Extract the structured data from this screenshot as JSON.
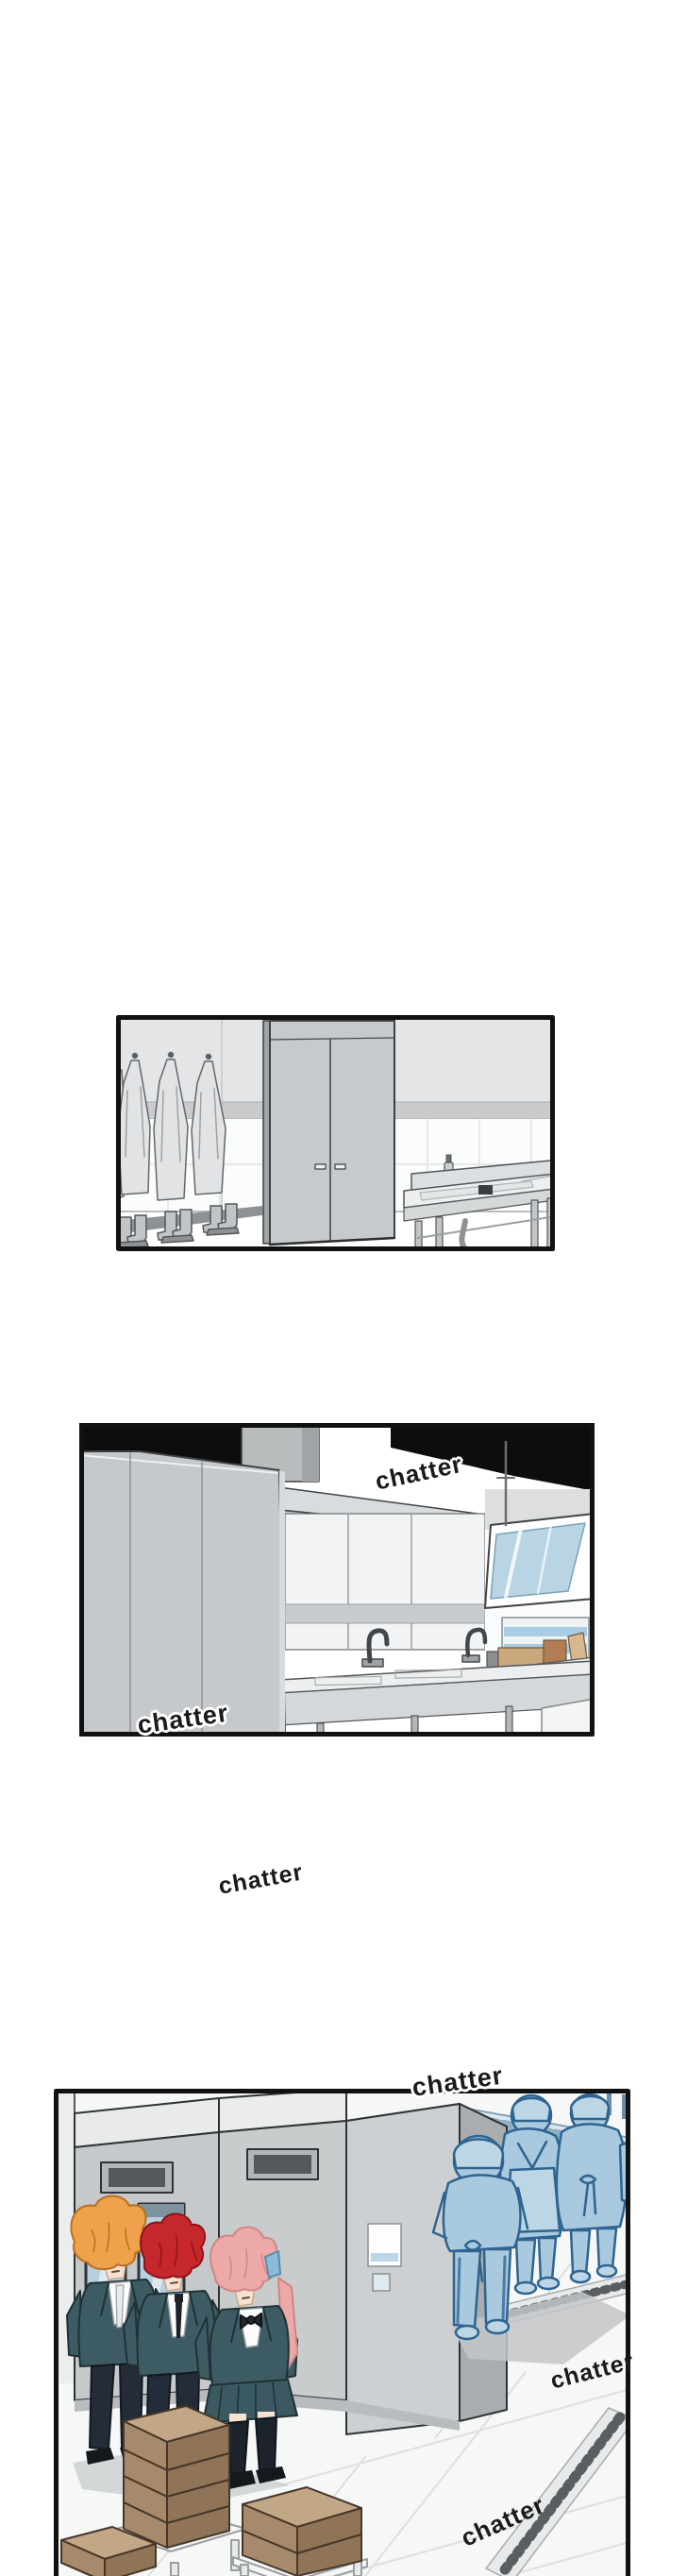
{
  "sfx": {
    "panel2_top": "chatter",
    "panel2_bottom_left": "chatter",
    "between_panels": "chatter",
    "panel3_top": "chatter",
    "panel3_right": "chatter",
    "panel3_bottom": "chatter"
  },
  "panels": [
    {
      "id": "panel-1",
      "scene": "locker area with hanging aprons, rubber boots, storage cabinet and sink"
    },
    {
      "id": "panel-2",
      "scene": "commercial kitchen with range hood, windows and prep counters"
    },
    {
      "id": "panel-3",
      "scene": "three students in uniform beside kitchen machines while blue-toned staff walk away"
    }
  ],
  "colors": {
    "page_background": "#ffffff",
    "panel_border": "#111111",
    "ceiling_black": "#0d0d0d",
    "machine_gray": "#c6c9cb",
    "glass_blue": "#b9d4e3",
    "uniform_jacket_teal": "#3d5b62",
    "hair_orange": "#efa24b",
    "hair_red": "#c6272d",
    "hair_pink": "#eca9a8",
    "ribbon_blue": "#8abbd8",
    "staff_blue_fill": "#a9c9df",
    "staff_blue_line": "#2e648f",
    "box_brown": "#a68a6b",
    "floor_white": "#f6f7f7"
  }
}
